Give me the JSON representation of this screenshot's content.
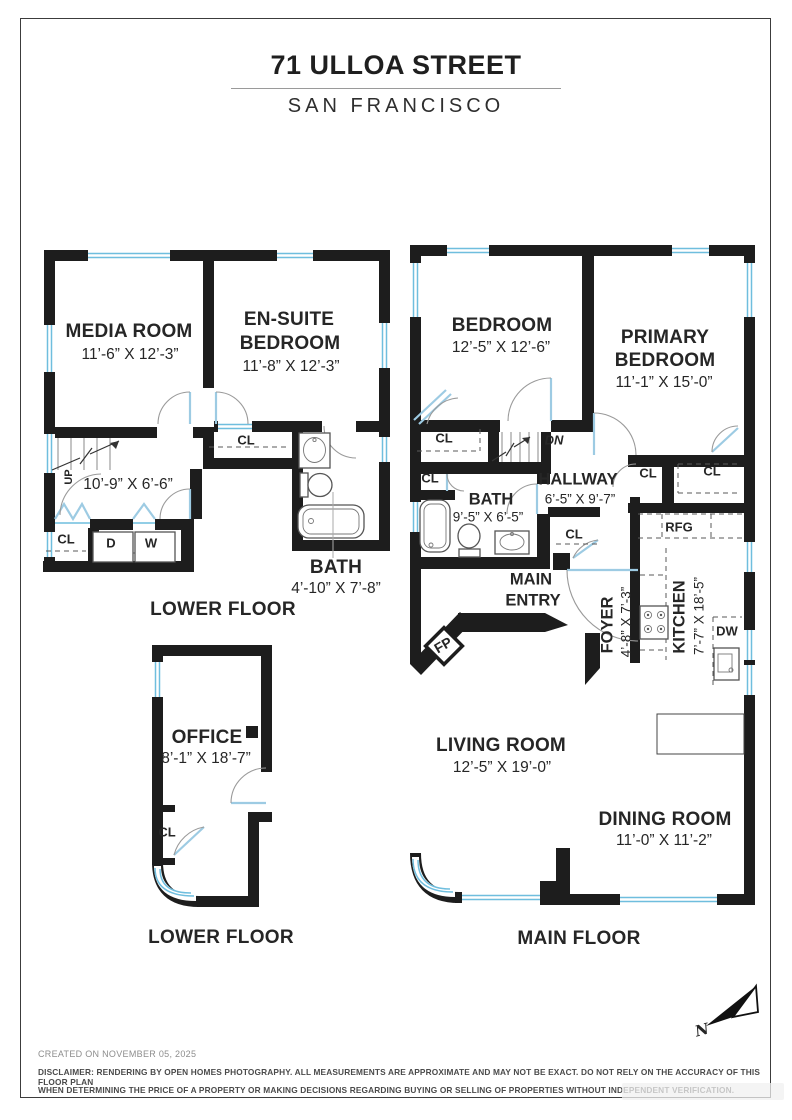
{
  "page_title": {
    "address": "71 ULLOA STREET",
    "city": "SAN FRANCISCO"
  },
  "floors": {
    "lower_a": {
      "floor_label": "LOWER FLOOR",
      "media_room": {
        "name": "MEDIA ROOM",
        "dims": "11’-6” X 12’-3”"
      },
      "ensuite_bedroom": {
        "name_line1": "EN-SUITE",
        "name_line2": "BEDROOM",
        "dims": "11’-8” X 12’-3”"
      },
      "stair_hall": {
        "dims": "10’-9” X 6’-6”",
        "up_label": "UP"
      },
      "bath": {
        "name": "BATH",
        "dims": "4’-10” X 7’-8”"
      },
      "closet_top": "CL",
      "closet_bottom": "CL",
      "dryer": "D",
      "washer": "W"
    },
    "lower_b": {
      "floor_label": "LOWER FLOOR",
      "office": {
        "name": "OFFICE",
        "dims": "8’-1” X 18’-7”"
      },
      "closet": "CL"
    },
    "main": {
      "floor_label": "MAIN FLOOR",
      "bedroom": {
        "name": "BEDROOM",
        "dims": "12’-5” X 12’-6”"
      },
      "primary_bedroom": {
        "name_line1": "PRIMARY",
        "name_line2": "BEDROOM",
        "dims": "11’-1” X 15’-0”"
      },
      "hallway": {
        "name": "HALLWAY",
        "dims": "6’-5” X 9’-7”"
      },
      "bath": {
        "name": "BATH",
        "dims": "9’-5” X 6’-5”"
      },
      "main_entry": {
        "name_line1": "MAIN",
        "name_line2": "ENTRY"
      },
      "foyer": {
        "name": "FOYER",
        "dims": "4’-8” X 7’-3”"
      },
      "kitchen": {
        "name": "KITCHEN",
        "dims": "7’-7” X 18’-5”"
      },
      "living_room": {
        "name": "LIVING ROOM",
        "dims": "12’-5” X 19’-0”"
      },
      "dining_room": {
        "name": "DINING ROOM",
        "dims": "11’-0” X 11’-2”"
      },
      "down_label": "DN",
      "refrigerator_label": "RFG",
      "dishwasher_label": "DW",
      "fireplace_label": "FP",
      "closet_bedroom": "CL",
      "closet_understairs": "CL",
      "closet_hall": "CL",
      "closet_primary_a": "CL",
      "closet_primary_b": "CL"
    }
  },
  "compass": {
    "north_label": "N"
  },
  "footer": {
    "created": "CREATED ON NOVEMBER 05, 2025",
    "disclaimer_line1": "DISCLAIMER: RENDERING BY OPEN HOMES PHOTOGRAPHY. ALL MEASUREMENTS ARE APPROXIMATE AND MAY NOT BE EXACT. DO NOT RELY ON THE ACCURACY OF THIS FLOOR PLAN",
    "disclaimer_line2": "WHEN DETERMINING THE PRICE OF A PROPERTY OR MAKING DECISIONS REGARDING BUYING OR SELLING OF PROPERTIES WITHOUT INDEPENDENT VERIFICATION."
  },
  "colors": {
    "wall": "#1d1d1d",
    "window_glass": "#6fbede",
    "door_leaf": "#9dcbe3"
  }
}
